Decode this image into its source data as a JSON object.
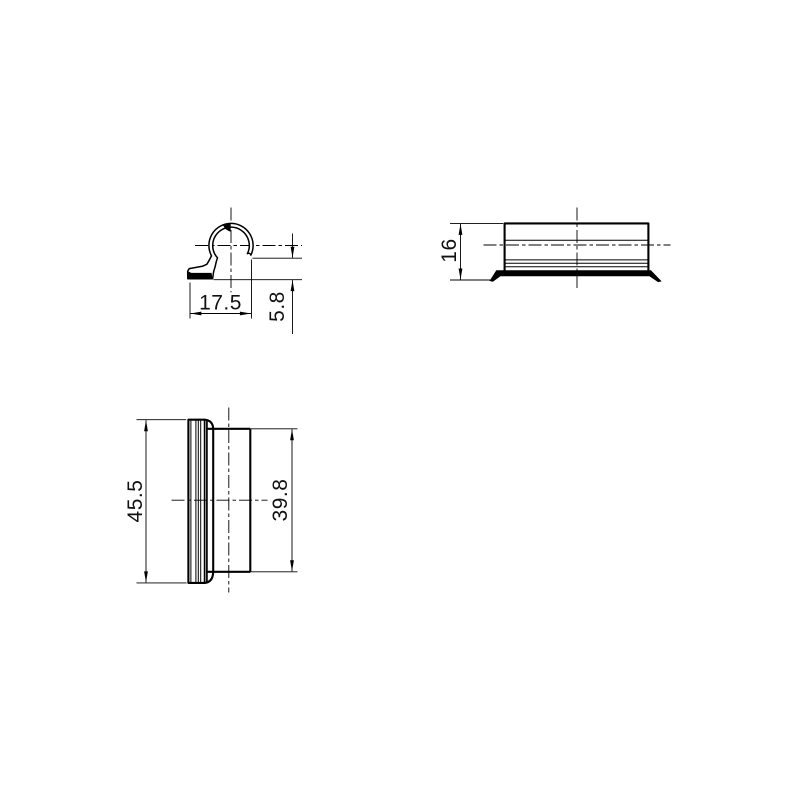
{
  "drawing": {
    "background": "#ffffff",
    "stroke_color": "#000000",
    "views": {
      "profile_view": {
        "width_dim": "17.5",
        "gap_height_dim": "5.8"
      },
      "side_view": {
        "height_dim": "16"
      },
      "plan_view": {
        "overall_length_dim": "45.5",
        "body_length_dim": "39.8"
      }
    }
  }
}
